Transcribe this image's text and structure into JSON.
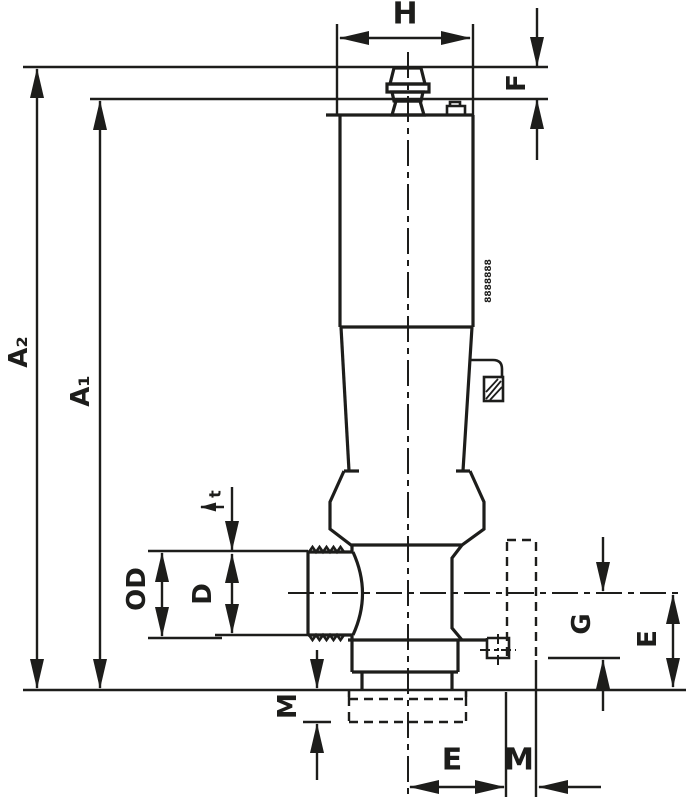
{
  "diagram": {
    "title": "valve-dimension-drawing",
    "colors": {
      "line": "#1d1d1b",
      "background": "#ffffff"
    },
    "labels": {
      "width_top": "H",
      "cap_height": "F",
      "overall_height": "A₂",
      "body_height": "A₁",
      "thread_depth": "t",
      "outer_diameter": "OD",
      "port_diameter": "D",
      "port_to_face": "G",
      "port_to_base": "E",
      "base_thread": "M",
      "center_to_end": "E",
      "end_thread": "M",
      "body_marking": "8888888"
    }
  }
}
